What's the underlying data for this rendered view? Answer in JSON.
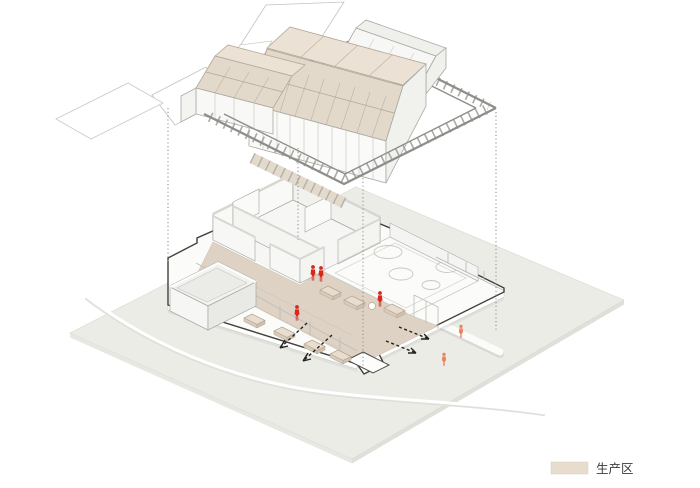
{
  "legend": {
    "items": [
      {
        "label": "生产区",
        "color": "#e7dcce"
      }
    ]
  },
  "colors": {
    "background": "#ffffff",
    "ground": "#ecece7",
    "site_outline": "#3f3f3b",
    "production_floor": "#ddd2c4",
    "roof_panel": "#e3d9cb",
    "roof_panel_light": "#ebe1d4",
    "walkway_panel": "#e4dacc",
    "person_indoor": "#d8281c",
    "person_outdoor": "#e8835b",
    "frame_gray": "#8d8d89",
    "legend_text": "#3a3a3a"
  },
  "annotations": {
    "indoor_person_count": 4,
    "outdoor_person_count": 2,
    "exit_arrow_count": 4,
    "projection_line_count": 4
  }
}
